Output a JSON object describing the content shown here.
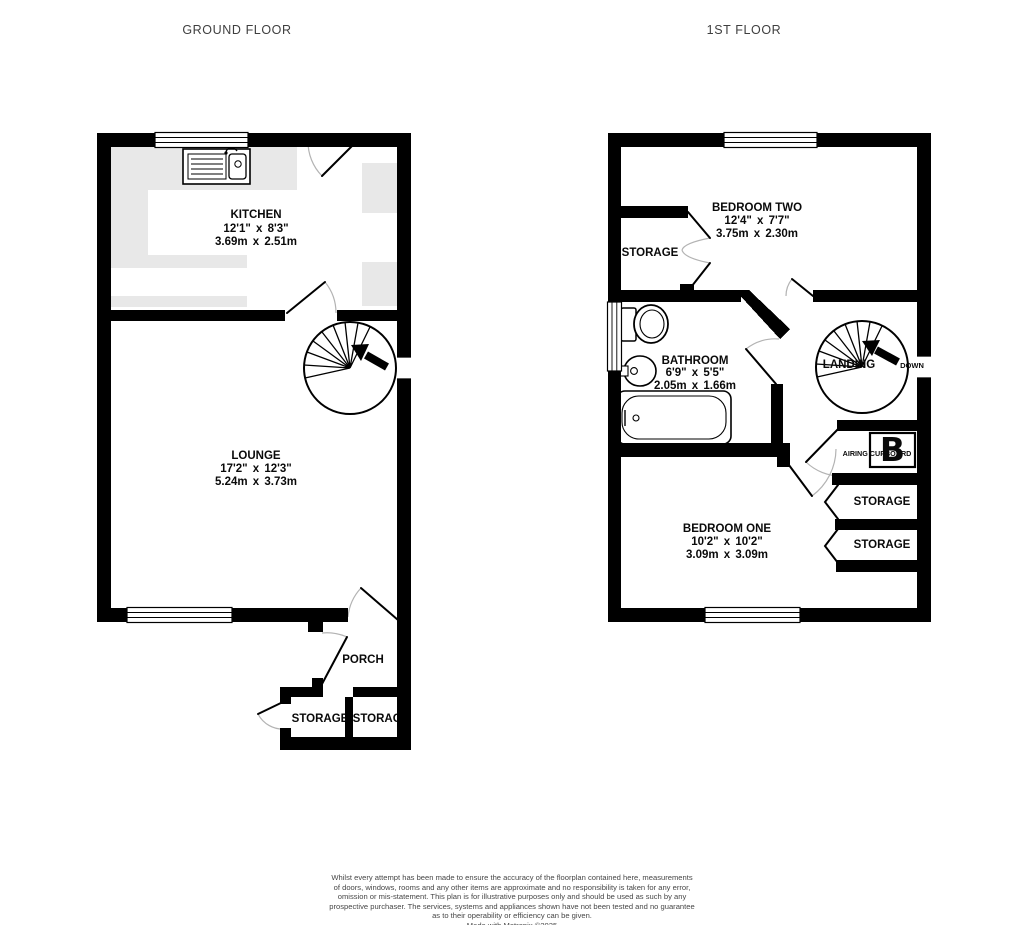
{
  "titles": {
    "ground": "GROUND FLOOR",
    "first": "1ST FLOOR"
  },
  "ground_floor": {
    "kitchen": {
      "name": "KITCHEN",
      "imperial": "12'1\" x 8'3\"",
      "metric": "3.69m x 2.51m"
    },
    "lounge": {
      "name": "LOUNGE",
      "imperial": "17'2\" x 12'3\"",
      "metric": "5.24m x 3.73m"
    },
    "porch": {
      "name": "PORCH"
    },
    "storage_left": {
      "name": "STORAGE"
    },
    "storage_right": {
      "name": "STORAGE"
    }
  },
  "first_floor": {
    "bedroom_two": {
      "name": "BEDROOM TWO",
      "imperial": "12'4\" x 7'7\"",
      "metric": "3.75m x 2.30m"
    },
    "storage": {
      "name": "STORAGE"
    },
    "bathroom": {
      "name": "BATHROOM",
      "imperial": "6'9\" x 5'5\"",
      "metric": "2.05m x 1.66m"
    },
    "landing": {
      "name": "LANDING",
      "down_label": "DOWN"
    },
    "airing_cupboard": {
      "name": "AIRING CUPBOARD",
      "boiler_glyph": "B"
    },
    "bedroom_one": {
      "name": "BEDROOM ONE",
      "imperial": "10'2\" x 10'2\"",
      "metric": "3.09m x 3.09m"
    },
    "storage_top": {
      "name": "STORAGE"
    },
    "storage_bottom": {
      "name": "STORAGE"
    }
  },
  "icons": {
    "stairs_up_arrow": "up-arrow",
    "sink": "kitchen-sink-with-drainer",
    "toilet": "toilet",
    "basin": "wash-basin",
    "bath": "bathtub",
    "boiler": "hot-water-cylinder"
  },
  "colors": {
    "wall": "#000000",
    "counter": "#e8e8e8",
    "title_text": "#3f3f3f",
    "label_text": "#0a0a0a",
    "disclaimer_text": "#474747",
    "door_arc": "#b3b3b3"
  },
  "disclaimer": {
    "lines": [
      "Whilst every attempt has been made to ensure the accuracy of the floorplan contained here, measurements",
      "of doors, windows, rooms and any other items are approximate and no responsibility is taken for any error,",
      "omission or mis-statement. This plan is for illustrative purposes only and should be used as such by any",
      "prospective purchaser. The services, systems and appliances shown have not been tested and no guarantee",
      "as to their operability or efficiency can be given.",
      "Made with Metropix ©2025"
    ]
  }
}
